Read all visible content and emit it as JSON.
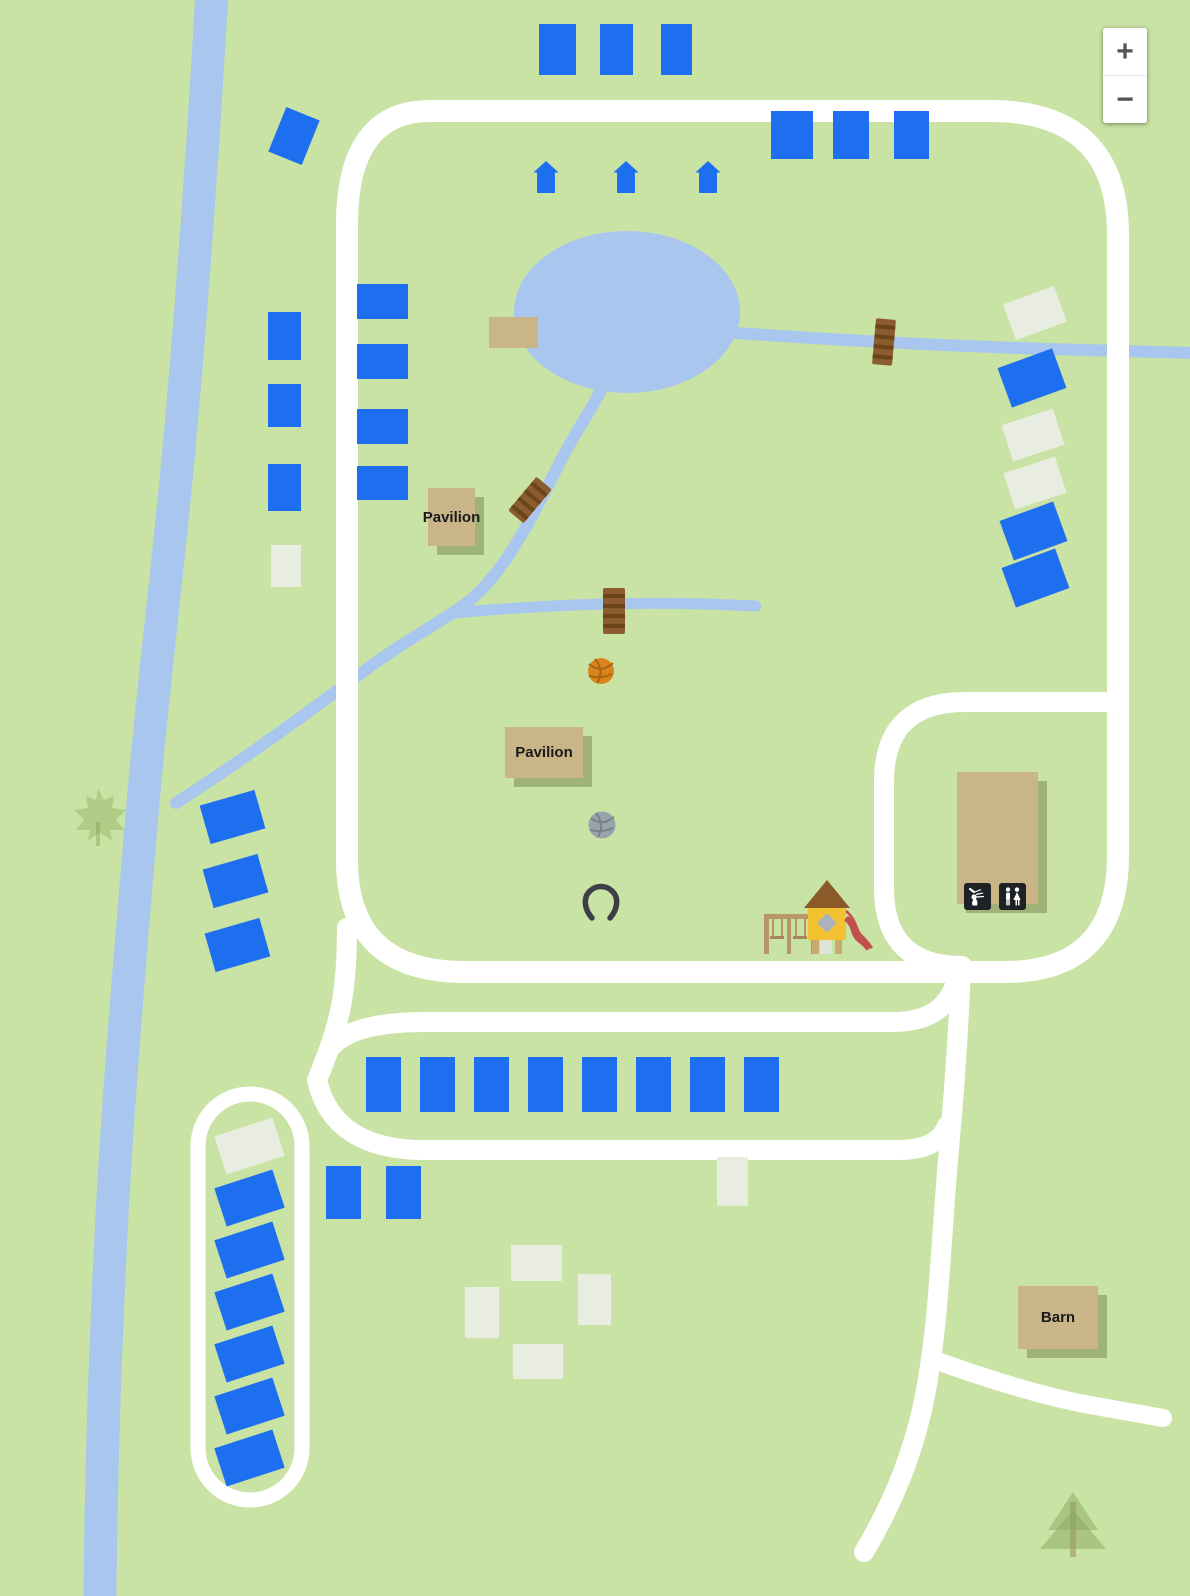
{
  "map": {
    "colors": {
      "background": "#c9e3a4",
      "water": "#a9c6ee",
      "road": "#ffffff",
      "campsite_blue": "#1e6ff0",
      "campsite_pale": "#e9ece1",
      "building_tan": "#c9b588",
      "bridge_brown": "#8a5c2e",
      "playground_yellow": "#f2c230",
      "slide_red": "#c0504a",
      "basketball_orange": "#d8861c",
      "volleyball_gray": "#9aa2ac"
    },
    "zoom_control": {
      "zoom_in_label": "+",
      "zoom_out_label": "−"
    },
    "buildings": {
      "pavilion_upper": "Pavilion",
      "pavilion_lower": "Pavilion",
      "barn": "Barn"
    },
    "sites_blue": [
      [
        539,
        24,
        37,
        51,
        0
      ],
      [
        600,
        24,
        33,
        51,
        0
      ],
      [
        661,
        24,
        31,
        51,
        0
      ],
      [
        276,
        112,
        36,
        48,
        22
      ],
      [
        771,
        111,
        42,
        48,
        0
      ],
      [
        833,
        111,
        36,
        48,
        0
      ],
      [
        894,
        111,
        35,
        48,
        0
      ],
      [
        268,
        312,
        33,
        48,
        0
      ],
      [
        268,
        384,
        33,
        43,
        0
      ],
      [
        268,
        464,
        33,
        47,
        0
      ],
      [
        357,
        284,
        51,
        35,
        0
      ],
      [
        357,
        344,
        51,
        35,
        0
      ],
      [
        357,
        409,
        51,
        35,
        0
      ],
      [
        357,
        466,
        51,
        34,
        0
      ],
      [
        1003,
        357,
        58,
        42,
        -20
      ],
      [
        1005,
        510,
        57,
        42,
        -20
      ],
      [
        1007,
        557,
        57,
        42,
        -20
      ],
      [
        204,
        797,
        57,
        40,
        -16
      ],
      [
        207,
        861,
        57,
        40,
        -16
      ],
      [
        209,
        925,
        57,
        40,
        -16
      ],
      [
        366,
        1057,
        35,
        55,
        0
      ],
      [
        420,
        1057,
        35,
        55,
        0
      ],
      [
        474,
        1057,
        35,
        55,
        0
      ],
      [
        528,
        1057,
        35,
        55,
        0
      ],
      [
        582,
        1057,
        35,
        55,
        0
      ],
      [
        636,
        1057,
        35,
        55,
        0
      ],
      [
        690,
        1057,
        35,
        55,
        0
      ],
      [
        744,
        1057,
        35,
        55,
        0
      ],
      [
        326,
        1166,
        35,
        53,
        0
      ],
      [
        386,
        1166,
        35,
        53,
        0
      ],
      [
        219,
        1178,
        61,
        40,
        -18
      ],
      [
        219,
        1230,
        61,
        40,
        -18
      ],
      [
        219,
        1282,
        61,
        40,
        -18
      ],
      [
        219,
        1334,
        61,
        40,
        -18
      ],
      [
        219,
        1386,
        61,
        40,
        -18
      ],
      [
        219,
        1438,
        61,
        40,
        -18
      ]
    ],
    "sites_pale": [
      [
        271,
        545,
        30,
        42,
        0
      ],
      [
        1008,
        294,
        54,
        38,
        -20
      ],
      [
        1006,
        416,
        54,
        38,
        -18
      ],
      [
        1008,
        464,
        54,
        38,
        -18
      ],
      [
        219,
        1126,
        61,
        40,
        -18
      ],
      [
        717,
        1157,
        31,
        49,
        0
      ],
      [
        511,
        1245,
        51,
        36,
        0
      ],
      [
        465,
        1287,
        34,
        51,
        0
      ],
      [
        578,
        1274,
        33,
        51,
        0
      ],
      [
        513,
        1344,
        50,
        35,
        0
      ]
    ],
    "tent_markers": [
      [
        532,
        161
      ],
      [
        612,
        161
      ],
      [
        694,
        161
      ]
    ]
  }
}
